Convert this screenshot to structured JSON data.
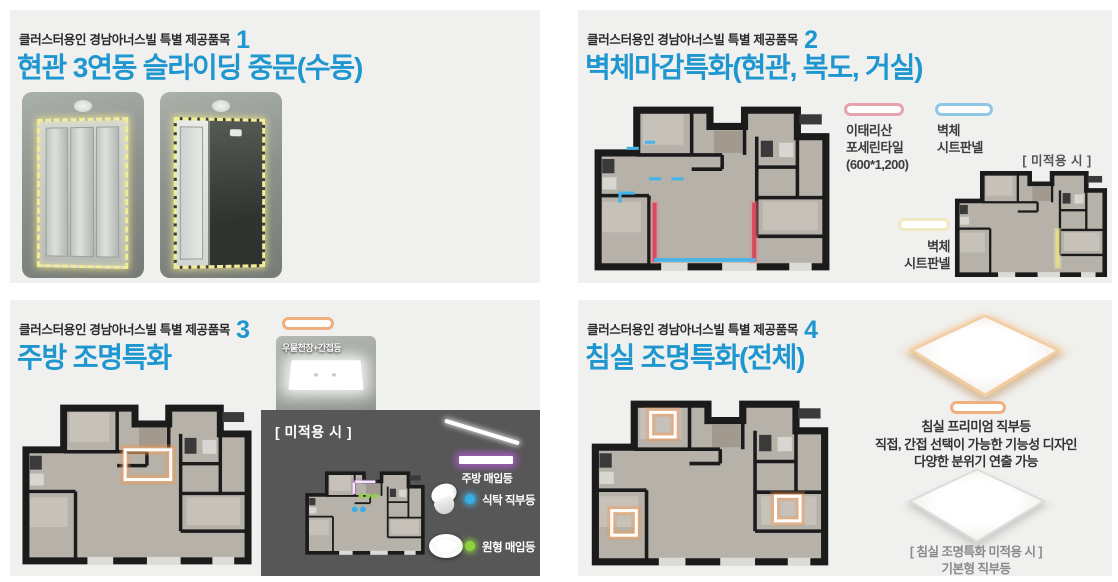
{
  "colors": {
    "title_blue": "#1e96d0",
    "panel_bg": "#f0f0ee",
    "porcelain_tile_pink": "#e6a3ad",
    "sheet_panel_blue": "#8fc6e6",
    "sheet_panel_yellow": "#efe9bd",
    "lighting_orange": "#f0af7e",
    "kitchen_light_purple": "#b05ecd",
    "table_light_blue": "#35aee8",
    "round_light_green": "#8fd23f"
  },
  "panels": {
    "p1": {
      "eyebrow": "클러스터용인 경남아너스빌 특별 제공품목",
      "number": "1",
      "title": "현관 3연동 슬라이딩 중문(수동)"
    },
    "p2": {
      "eyebrow": "클러스터용인 경남아너스빌 특별 제공품목",
      "number": "2",
      "title": "벽체마감특화(현관, 복도, 거실)",
      "legend_tile_lines": [
        "이태리산",
        "포세린타일",
        "(600*1,200)"
      ],
      "legend_sheet_lines": [
        "벽체",
        "시트판넬"
      ],
      "legend_sheet2_lines": [
        "벽체",
        "시트판넬"
      ],
      "not_applied": "[ 미적용 시 ]"
    },
    "p3": {
      "eyebrow": "클러스터용인 경남아너스빌 특별 제공품목",
      "number": "3",
      "title": "주방 조명특화",
      "photo_label": "우물천장+간접등",
      "not_applied": "[ 미적용 시 ]",
      "legend_linear": "주방 매입등",
      "legend_spot": "식탁 직부등",
      "legend_round": "원형 매입등"
    },
    "p4": {
      "eyebrow": "클러스터용인 경남아너스빌 특별 제공품목",
      "number": "4",
      "title": "침실 조명특화(전체)",
      "premium_lines": [
        "침실 프리미엄 직부등",
        "직접, 간접 선택이 가능한 기능성 디자인",
        "다양한 분위기 연출 가능"
      ],
      "basic_lines": [
        "[ 침실 조명특화 미적용 시 ]",
        "기본형 직부등"
      ]
    }
  }
}
